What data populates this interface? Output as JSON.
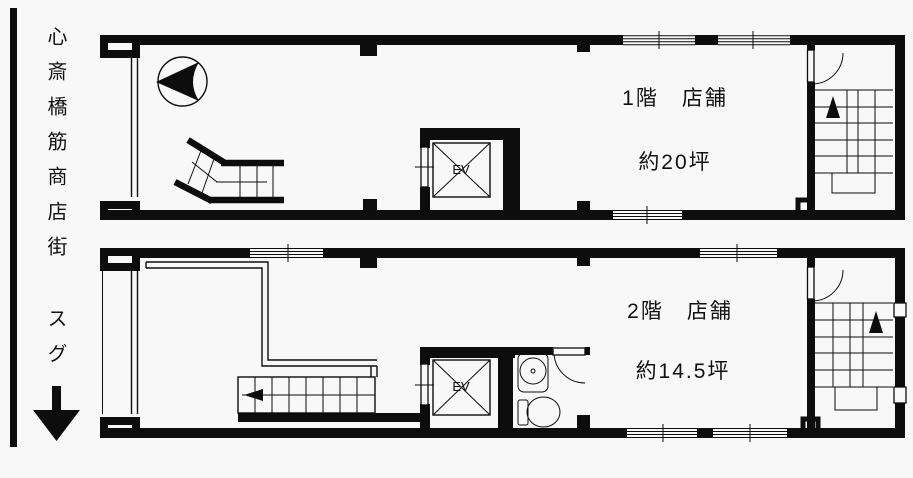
{
  "page": {
    "background": "#f8f8f8",
    "ink": "#0d0d0d"
  },
  "sidebar": {
    "street_label": "心斎橋筋商店街 スグ",
    "down_arrow_icon": "↓"
  },
  "floor1": {
    "name_label": "1階　店舗",
    "area_label": "約20坪",
    "elevator_label": "EV"
  },
  "floor2": {
    "name_label": "2階　店舗",
    "area_label": "約14.5坪",
    "elevator_label": "EV"
  }
}
